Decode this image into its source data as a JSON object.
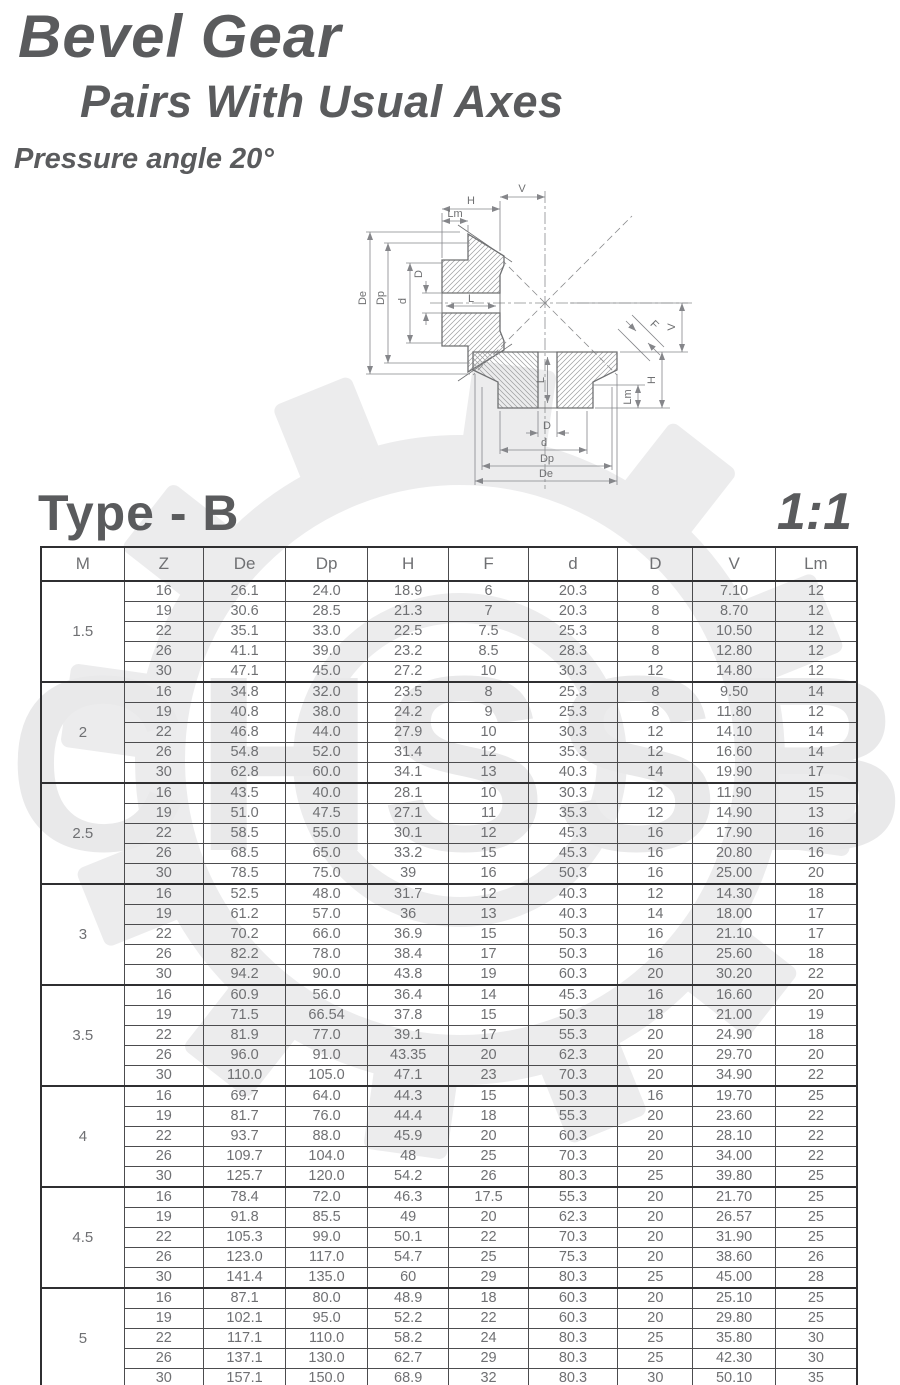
{
  "header": {
    "title_line1": "Bevel Gear",
    "title_line2": "Pairs With Usual Axes",
    "pressure_angle": "Pressure angle 20°"
  },
  "section": {
    "type_label": "Type - B",
    "ratio_label": "1:1"
  },
  "watermark": {
    "text": "CHSSB"
  },
  "diagram": {
    "labels": {
      "V": "V",
      "H": "H",
      "Lm": "Lm",
      "De": "De",
      "Dp": "Dp",
      "d": "d",
      "D": "D",
      "L": "L",
      "F": "F"
    }
  },
  "colors": {
    "title": "#5a5b5d",
    "table_text": "#6f7073",
    "border_thin": "#4c4c4e",
    "border_thick": "#2f2f31",
    "watermark": "#ececed",
    "drawing_line": "#6f7072"
  },
  "table": {
    "columns": [
      "M",
      "Z",
      "De",
      "Dp",
      "H",
      "F",
      "d",
      "D",
      "V",
      "Lm"
    ],
    "col_widths": [
      "10.2%",
      "9.7%",
      "10.1%",
      "10.0%",
      "10.0%",
      "9.7%",
      "11.0%",
      "9.2%",
      "10.1%",
      "10.0%"
    ],
    "groups": [
      {
        "m": "1.5",
        "rows": [
          [
            "16",
            "26.1",
            "24.0",
            "18.9",
            "6",
            "20.3",
            "8",
            "7.10",
            "12"
          ],
          [
            "19",
            "30.6",
            "28.5",
            "21.3",
            "7",
            "20.3",
            "8",
            "8.70",
            "12"
          ],
          [
            "22",
            "35.1",
            "33.0",
            "22.5",
            "7.5",
            "25.3",
            "8",
            "10.50",
            "12"
          ],
          [
            "26",
            "41.1",
            "39.0",
            "23.2",
            "8.5",
            "28.3",
            "8",
            "12.80",
            "12"
          ],
          [
            "30",
            "47.1",
            "45.0",
            "27.2",
            "10",
            "30.3",
            "12",
            "14.80",
            "12"
          ]
        ]
      },
      {
        "m": "2",
        "rows": [
          [
            "16",
            "34.8",
            "32.0",
            "23.5",
            "8",
            "25.3",
            "8",
            "9.50",
            "14"
          ],
          [
            "19",
            "40.8",
            "38.0",
            "24.2",
            "9",
            "25.3",
            "8",
            "11.80",
            "12"
          ],
          [
            "22",
            "46.8",
            "44.0",
            "27.9",
            "10",
            "30.3",
            "12",
            "14.10",
            "14"
          ],
          [
            "26",
            "54.8",
            "52.0",
            "31.4",
            "12",
            "35.3",
            "12",
            "16.60",
            "14"
          ],
          [
            "30",
            "62.8",
            "60.0",
            "34.1",
            "13",
            "40.3",
            "14",
            "19.90",
            "17"
          ]
        ]
      },
      {
        "m": "2.5",
        "rows": [
          [
            "16",
            "43.5",
            "40.0",
            "28.1",
            "10",
            "30.3",
            "12",
            "11.90",
            "15"
          ],
          [
            "19",
            "51.0",
            "47.5",
            "27.1",
            "11",
            "35.3",
            "12",
            "14.90",
            "13"
          ],
          [
            "22",
            "58.5",
            "55.0",
            "30.1",
            "12",
            "45.3",
            "16",
            "17.90",
            "16"
          ],
          [
            "26",
            "68.5",
            "65.0",
            "33.2",
            "15",
            "45.3",
            "16",
            "20.80",
            "16"
          ],
          [
            "30",
            "78.5",
            "75.0",
            "39",
            "16",
            "50.3",
            "16",
            "25.00",
            "20"
          ]
        ]
      },
      {
        "m": "3",
        "rows": [
          [
            "16",
            "52.5",
            "48.0",
            "31.7",
            "12",
            "40.3",
            "12",
            "14.30",
            "18"
          ],
          [
            "19",
            "61.2",
            "57.0",
            "36",
            "13",
            "40.3",
            "14",
            "18.00",
            "17"
          ],
          [
            "22",
            "70.2",
            "66.0",
            "36.9",
            "15",
            "50.3",
            "16",
            "21.10",
            "17"
          ],
          [
            "26",
            "82.2",
            "78.0",
            "38.4",
            "17",
            "50.3",
            "16",
            "25.60",
            "18"
          ],
          [
            "30",
            "94.2",
            "90.0",
            "43.8",
            "19",
            "60.3",
            "20",
            "30.20",
            "22"
          ]
        ]
      },
      {
        "m": "3.5",
        "rows": [
          [
            "16",
            "60.9",
            "56.0",
            "36.4",
            "14",
            "45.3",
            "16",
            "16.60",
            "20"
          ],
          [
            "19",
            "71.5",
            "66.54",
            "37.8",
            "15",
            "50.3",
            "18",
            "21.00",
            "19"
          ],
          [
            "22",
            "81.9",
            "77.0",
            "39.1",
            "17",
            "55.3",
            "20",
            "24.90",
            "18"
          ],
          [
            "26",
            "96.0",
            "91.0",
            "43.35",
            "20",
            "62.3",
            "20",
            "29.70",
            "20"
          ],
          [
            "30",
            "110.0",
            "105.0",
            "47.1",
            "23",
            "70.3",
            "20",
            "34.90",
            "22"
          ]
        ]
      },
      {
        "m": "4",
        "rows": [
          [
            "16",
            "69.7",
            "64.0",
            "44.3",
            "15",
            "50.3",
            "16",
            "19.70",
            "25"
          ],
          [
            "19",
            "81.7",
            "76.0",
            "44.4",
            "18",
            "55.3",
            "20",
            "23.60",
            "22"
          ],
          [
            "22",
            "93.7",
            "88.0",
            "45.9",
            "20",
            "60.3",
            "20",
            "28.10",
            "22"
          ],
          [
            "26",
            "109.7",
            "104.0",
            "48",
            "25",
            "70.3",
            "20",
            "34.00",
            "22"
          ],
          [
            "30",
            "125.7",
            "120.0",
            "54.2",
            "26",
            "80.3",
            "25",
            "39.80",
            "25"
          ]
        ]
      },
      {
        "m": "4.5",
        "rows": [
          [
            "16",
            "78.4",
            "72.0",
            "46.3",
            "17.5",
            "55.3",
            "20",
            "21.70",
            "25"
          ],
          [
            "19",
            "91.8",
            "85.5",
            "49",
            "20",
            "62.3",
            "20",
            "26.57",
            "25"
          ],
          [
            "22",
            "105.3",
            "99.0",
            "50.1",
            "22",
            "70.3",
            "20",
            "31.90",
            "25"
          ],
          [
            "26",
            "123.0",
            "117.0",
            "54.7",
            "25",
            "75.3",
            "20",
            "38.60",
            "26"
          ],
          [
            "30",
            "141.4",
            "135.0",
            "60",
            "29",
            "80.3",
            "25",
            "45.00",
            "28"
          ]
        ]
      },
      {
        "m": "5",
        "rows": [
          [
            "16",
            "87.1",
            "80.0",
            "48.9",
            "18",
            "60.3",
            "20",
            "25.10",
            "25"
          ],
          [
            "19",
            "102.1",
            "95.0",
            "52.2",
            "22",
            "60.3",
            "20",
            "29.80",
            "25"
          ],
          [
            "22",
            "117.1",
            "110.0",
            "58.2",
            "24",
            "80.3",
            "25",
            "35.80",
            "30"
          ],
          [
            "26",
            "137.1",
            "130.0",
            "62.7",
            "29",
            "80.3",
            "25",
            "42.30",
            "30"
          ],
          [
            "30",
            "157.1",
            "150.0",
            "68.9",
            "32",
            "80.3",
            "30",
            "50.10",
            "35"
          ]
        ]
      }
    ]
  }
}
